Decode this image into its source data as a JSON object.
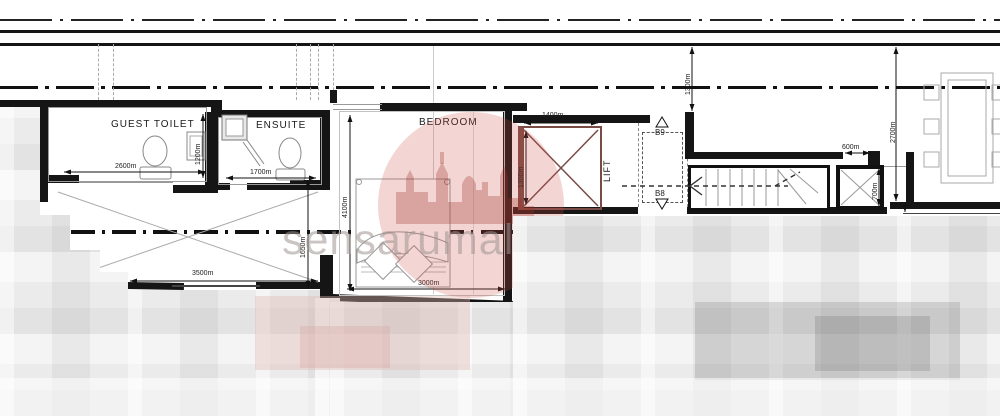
{
  "watermark": {
    "text": "sensarumalta"
  },
  "rooms": {
    "guest_toilet": {
      "label": "GUEST TOILET",
      "width_dim": "2600m",
      "depth_dim": "1200m"
    },
    "ensuite": {
      "label": "ENSUITE",
      "width_dim": "1700m"
    },
    "bedroom": {
      "label": "BEDROOM",
      "width_dim": "3000m",
      "depth_dim": "4100m"
    },
    "corridor": {
      "width_dim": "3500m",
      "depth_dim": "1650m"
    },
    "lift": {
      "label": "LIFT",
      "width_dim": "1400m",
      "depth_dim": "1300m"
    },
    "stair_bay": {
      "marker_top": "B9",
      "marker_bottom": "B8",
      "front_dim": "1300m"
    },
    "service_shaft": {
      "width_dim": "600m",
      "depth_dim": "700m"
    },
    "right_bay": {
      "depth_dim": "2700m"
    }
  },
  "colors": {
    "wall": "#151515",
    "thin_line": "#999999",
    "lift_accent": "#7a4a45",
    "watermark_red": "#cd554b",
    "watermark_text": "#9e9491"
  }
}
